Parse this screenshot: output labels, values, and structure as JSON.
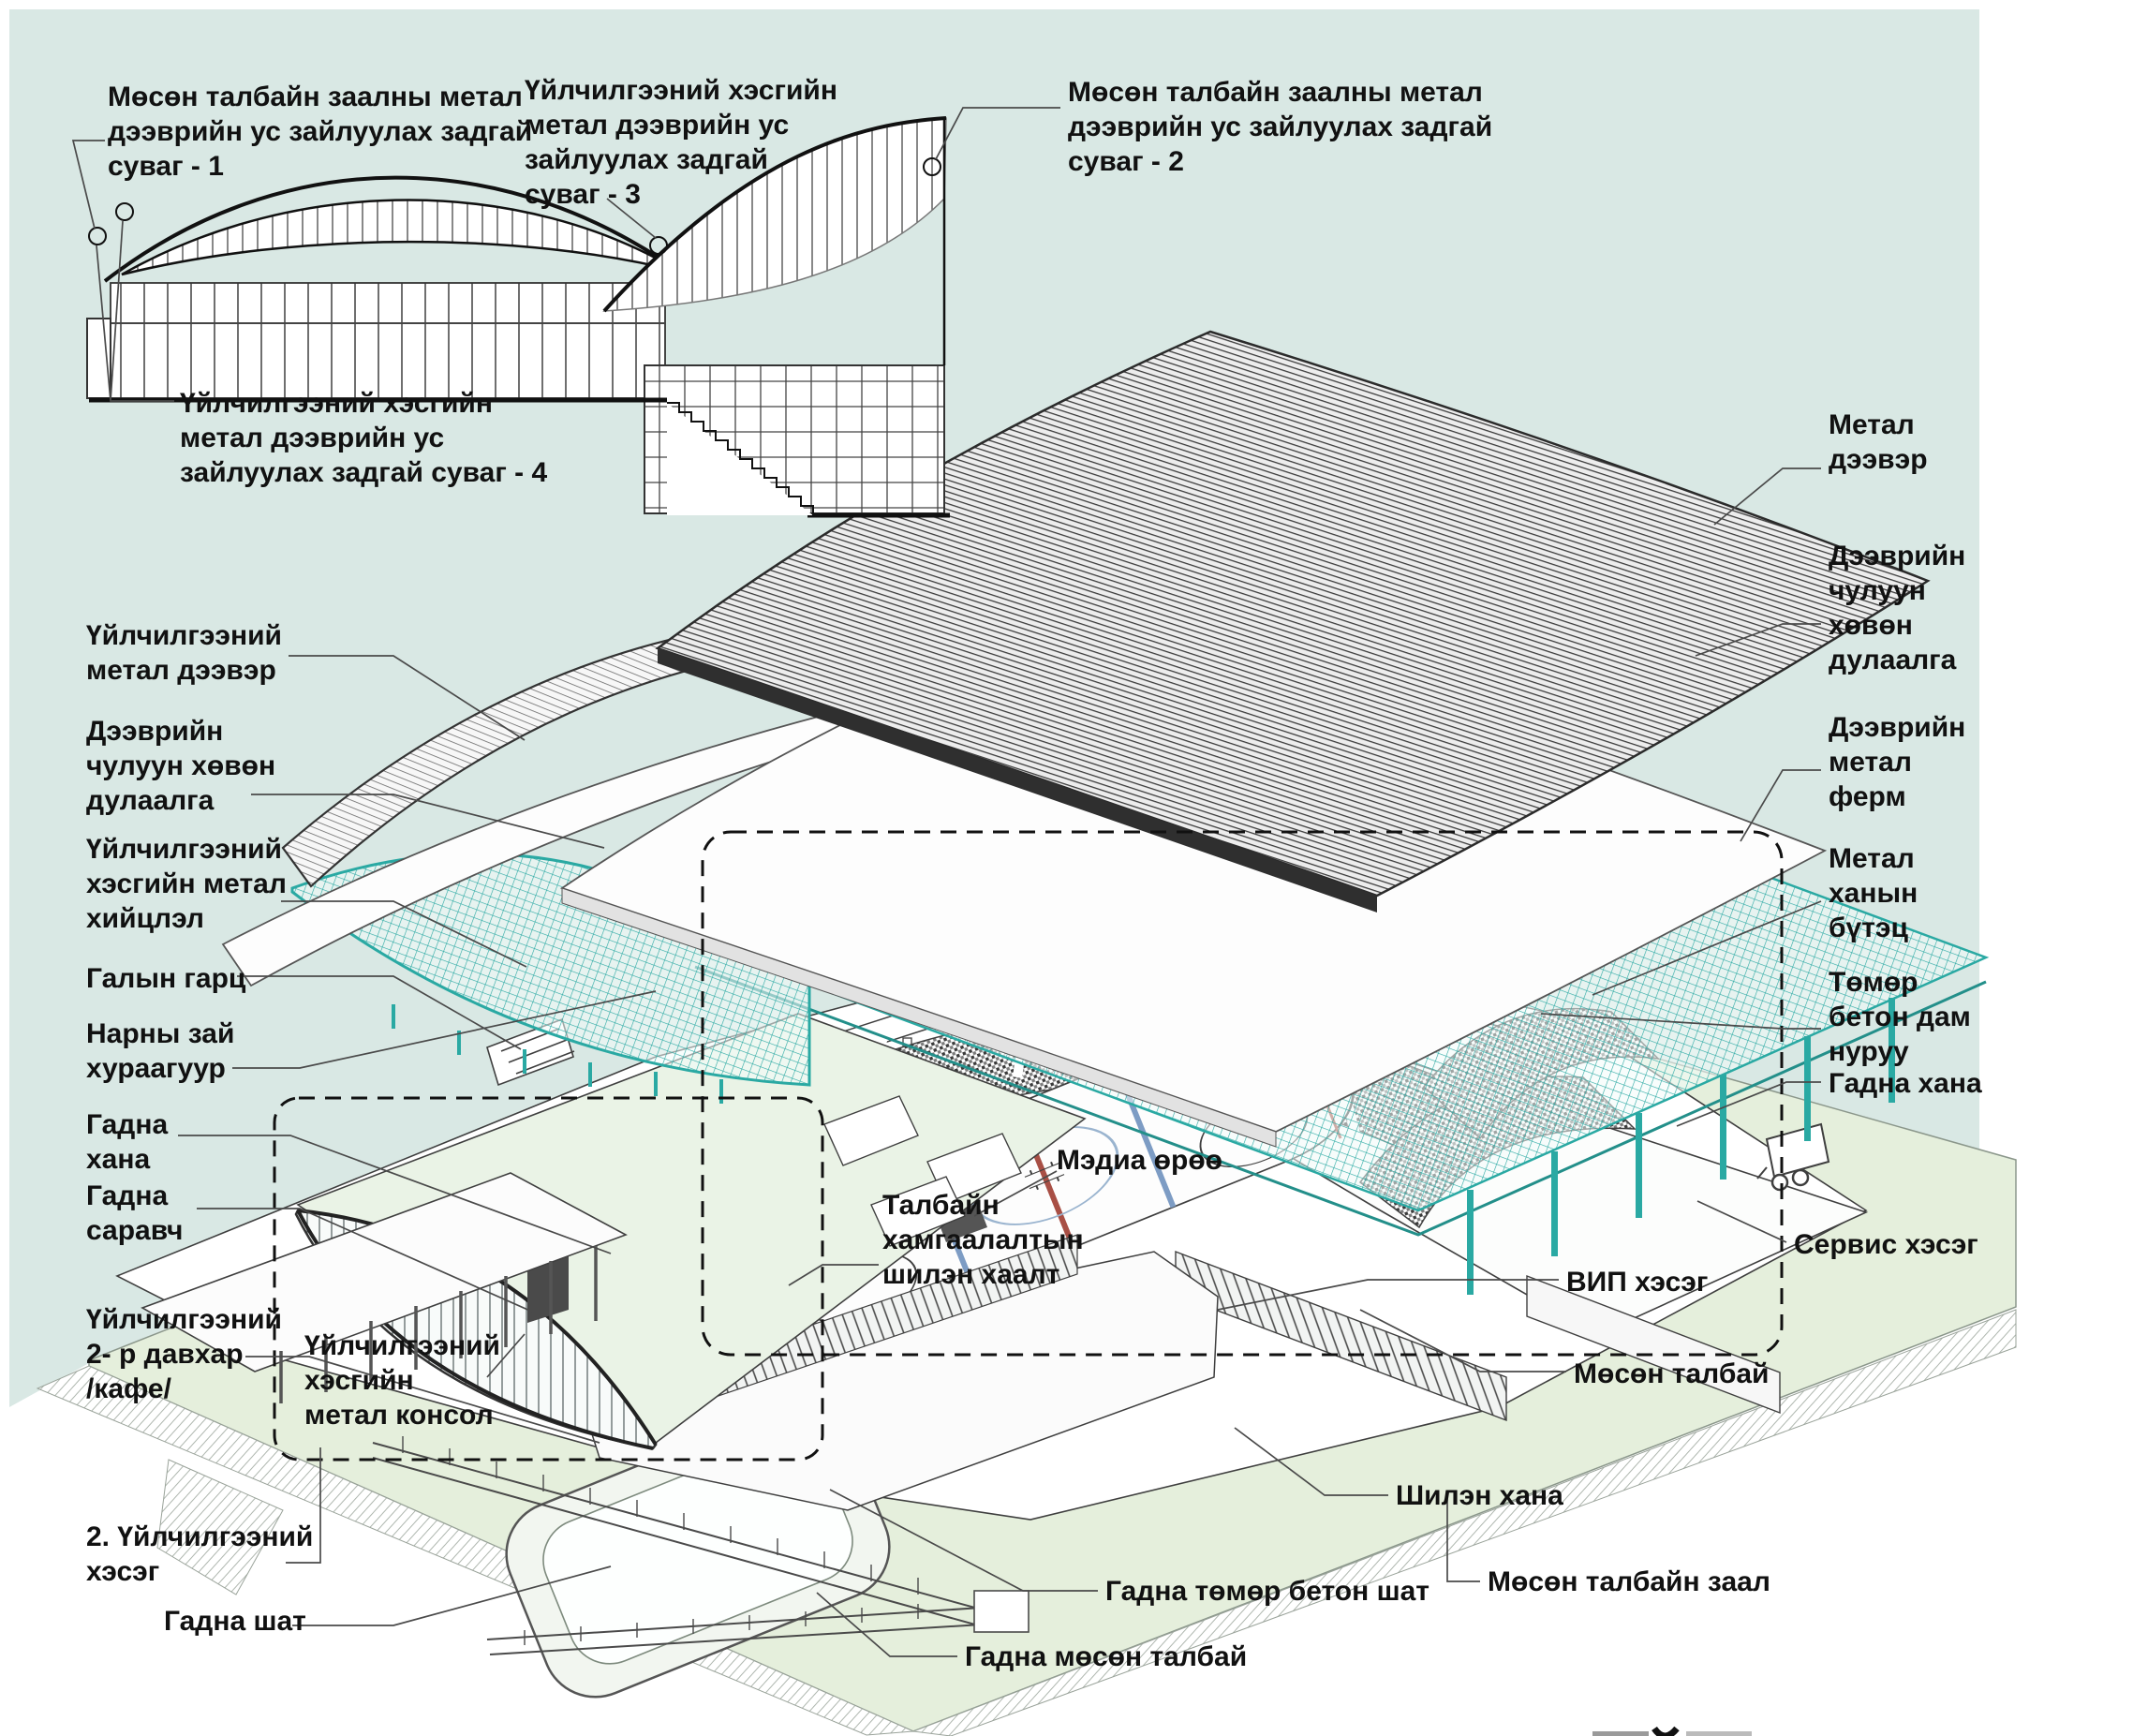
{
  "diagram": {
    "title_hidden": "",
    "colors": {
      "background": "#d9e8e4",
      "ground": "#e5efdc",
      "truss": "#2aa9a3",
      "ink": "#111111",
      "line": "#4a4a4a",
      "rink_red": "#a84f45",
      "rink_blue": "#7d9cc4"
    },
    "labels": [
      {
        "id": "drain-channel-1",
        "text": "Мөсөн талбайн заалны метал\nдээврийн ус зайлуулах задгай\nсуваг - 1"
      },
      {
        "id": "drain-channel-3",
        "text": "Үйлчилгээний хэсгийн\nметал дээврийн ус\nзайлуулах задгай\nсуваг - 3"
      },
      {
        "id": "drain-channel-2",
        "text": "Мөсөн талбайн заалны метал\nдээврийн ус зайлуулах задгай\nсуваг - 2"
      },
      {
        "id": "drain-channel-4",
        "text": "Үйлчилгээний хэсгийн\nметал дээврийн ус\nзайлуулах задгай суваг - 4"
      },
      {
        "id": "metal-roof",
        "text": "Метал\nдээвэр"
      },
      {
        "id": "roof-insulation-right",
        "text": "Дээврийн\nчулуун\nхөвөн\nдулаалга"
      },
      {
        "id": "roof-metal-truss",
        "text": "Дээврийн\nметал\nферм"
      },
      {
        "id": "metal-wall-structure",
        "text": "Метал\nханын\nбүтэц"
      },
      {
        "id": "concrete-beam",
        "text": "Төмөр\nбетон дам\nнуруу"
      },
      {
        "id": "outer-wall-right",
        "text": "Гадна хана"
      },
      {
        "id": "service-zone",
        "text": "Сервис хэсэг"
      },
      {
        "id": "vip-zone",
        "text": "ВИП хэсэг"
      },
      {
        "id": "ice-field",
        "text": "Мөсөн талбай"
      },
      {
        "id": "glass-wall",
        "text": "Шилэн хана"
      },
      {
        "id": "ice-hall",
        "text": "Мөсөн талбайн заал"
      },
      {
        "id": "outdoor-concrete-stair",
        "text": "Гадна төмөр бетон шат"
      },
      {
        "id": "outdoor-ice-field",
        "text": "Гадна мөсөн талбай"
      },
      {
        "id": "service-metal-roof",
        "text": "Үйлчилгээний\nметал дээвэр"
      },
      {
        "id": "roof-insulation-left",
        "text": "Дээврийн\nчулуун хөвөн\nдулаалга"
      },
      {
        "id": "service-metal-structure",
        "text": "Үйлчилгээний\nхэсгийн метал\nхийцлэл"
      },
      {
        "id": "fire-exit",
        "text": "Галын гарц"
      },
      {
        "id": "solar-collector",
        "text": "Нарны зай\nхураагуур"
      },
      {
        "id": "outer-wall-left",
        "text": "Гадна\nхана"
      },
      {
        "id": "outer-canopy",
        "text": "Гадна\nсаравч"
      },
      {
        "id": "service-2nd-floor",
        "text": "Үйлчилгээний\n2- р давхар\n/кафе/"
      },
      {
        "id": "service-metal-console",
        "text": "Үйлчилгээний\nхэсгийн\nметал консол"
      },
      {
        "id": "service-section-2",
        "text": "2. Үйлчилгээний\nхэсэг"
      },
      {
        "id": "outdoor-stair",
        "text": "Гадна шат"
      },
      {
        "id": "media-room",
        "text": "Мэдиа өрөө"
      },
      {
        "id": "rink-protective-glass",
        "text": "Талбайн\nхамгаалалтын\nшилэн хаалт"
      }
    ]
  }
}
